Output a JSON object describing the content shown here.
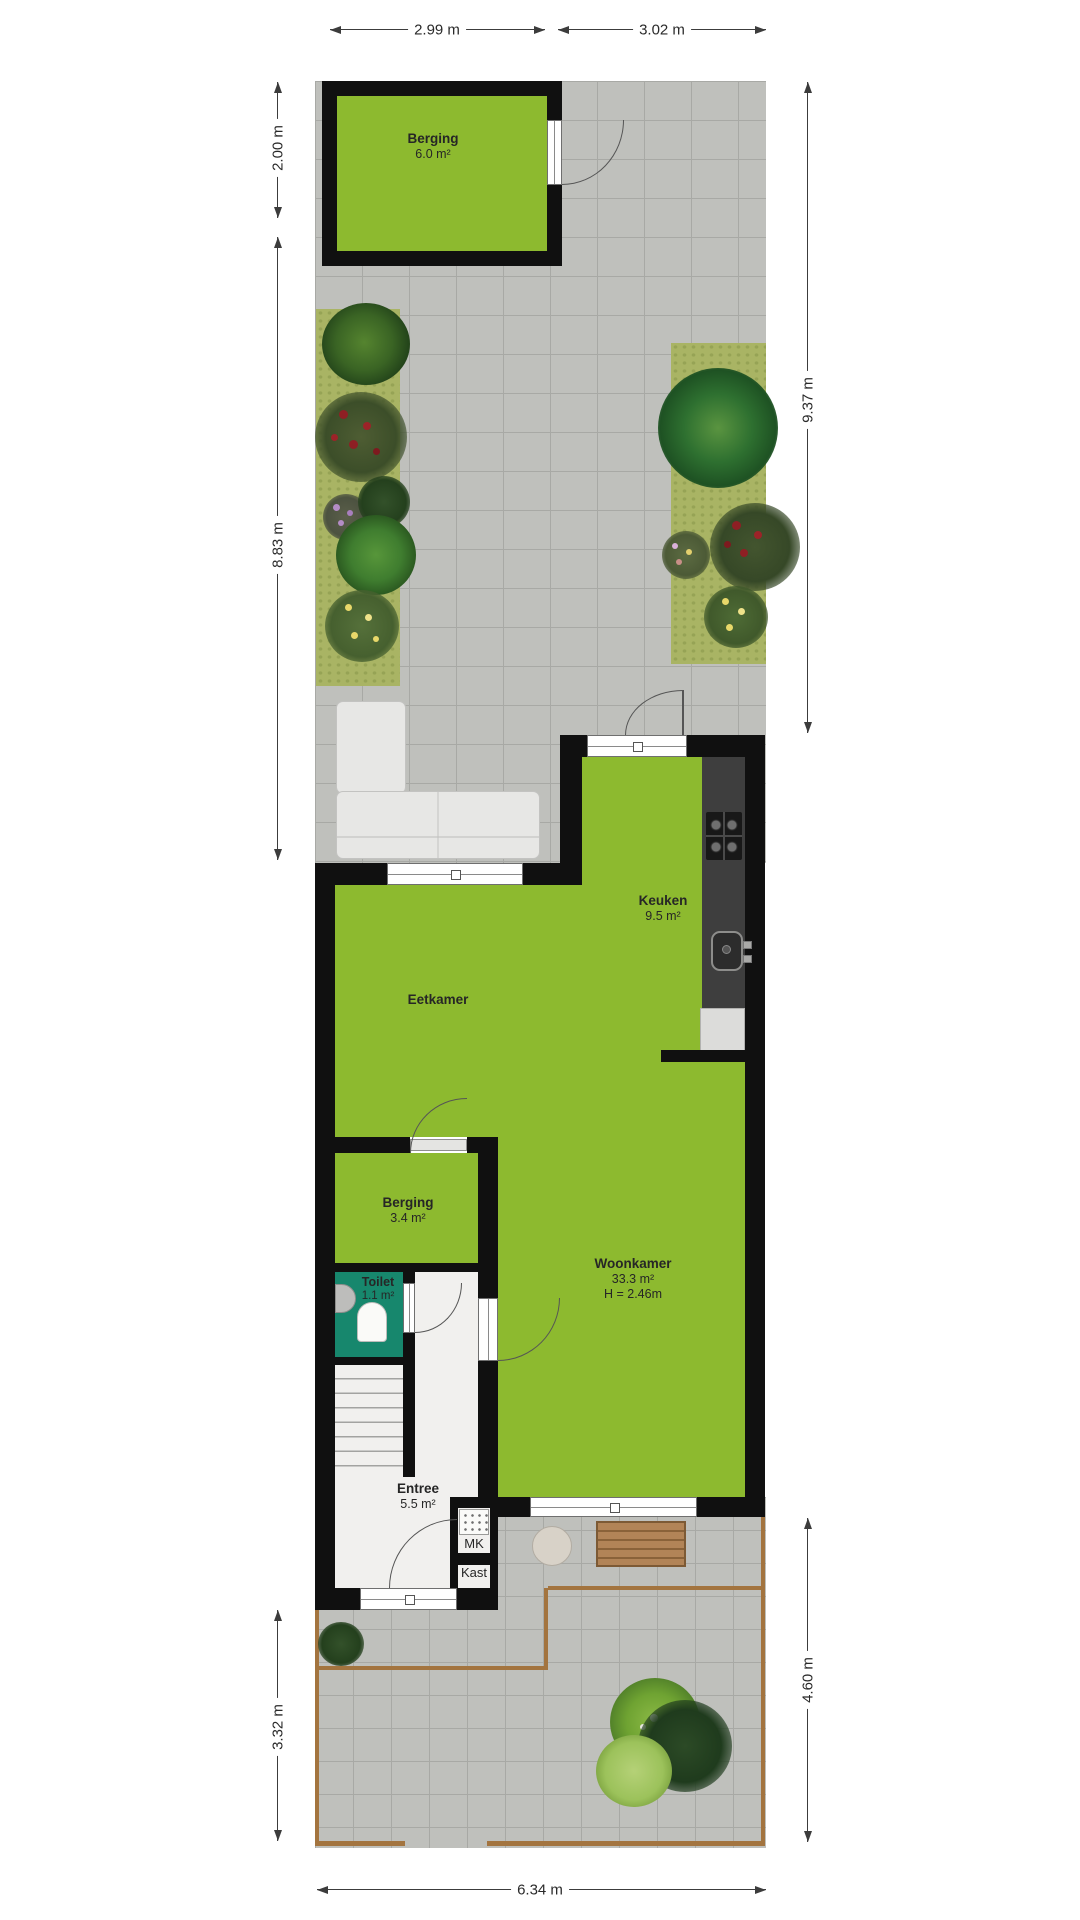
{
  "dims": {
    "top_left": "2.99 m",
    "top_right": "3.02 m",
    "left_top": "2.00 m",
    "left_mid": "8.83 m",
    "left_bottom": "3.32 m",
    "right_top": "9.37 m",
    "right_bottom": "4.60 m",
    "bottom": "6.34 m"
  },
  "rooms": {
    "shed": {
      "name": "Berging",
      "area": "6.0 m²"
    },
    "kitchen": {
      "name": "Keuken",
      "area": "9.5 m²"
    },
    "dining": {
      "name": "Eetkamer"
    },
    "storage": {
      "name": "Berging",
      "area": "3.4 m²"
    },
    "toilet": {
      "name": "Toilet",
      "area": "1.1 m²"
    },
    "living": {
      "name": "Woonkamer",
      "area": "33.3 m²",
      "ceiling": "H = 2.46m"
    },
    "entry": {
      "name": "Entree",
      "area": "5.5 m²"
    },
    "meter_cupboard": {
      "name": "MK"
    },
    "closet": {
      "name": "Kast"
    }
  },
  "colors": {
    "room_green": "#8dba2f",
    "toilet_teal": "#17876d",
    "wall_black": "#101010",
    "paving": "#bfc0bc",
    "paving_joint": "#a8a9a5",
    "grass": "#a9b464",
    "entry_floor": "#f1f0ee",
    "counter_dark": "#3e3e3e",
    "wood": "#b28457",
    "border_path": "#a3743f"
  }
}
